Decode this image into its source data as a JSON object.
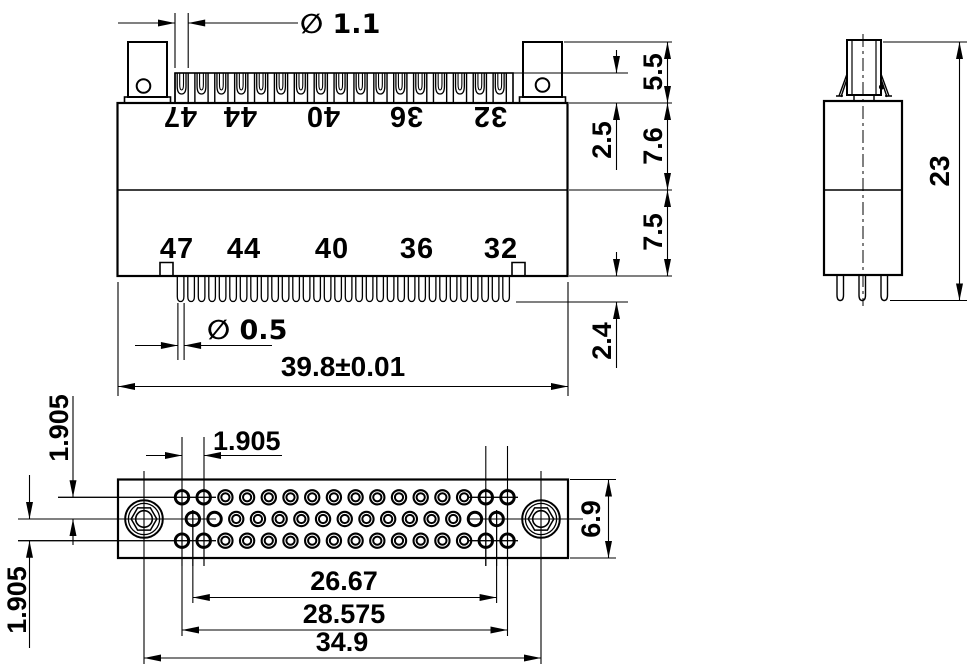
{
  "drawing_type": "connector-technical-drawing",
  "views": {
    "front": {
      "upper_labels": [
        "47",
        "44",
        "40",
        "36",
        "32"
      ],
      "lower_labels": [
        "47",
        "44",
        "40",
        "36",
        "32"
      ],
      "slot_count": 17,
      "pin_count": 32,
      "dims": {
        "slot_width_dia": "∅ 1.1",
        "pin_width_dia": "∅ 0.5",
        "overall_width": "39.8±0.01",
        "tab_height": "5.5",
        "upper_body_height": "7.6",
        "lower_body_height": "7.5",
        "contact_recess": "2.5",
        "pin_protrusion": "2.4"
      }
    },
    "side": {
      "pin_count": 3,
      "dims": {
        "overall_height": "23"
      }
    },
    "face": {
      "outer_row_holes": 16,
      "middle_row_holes": 15,
      "dims": {
        "hole_pitch": "1.905",
        "row_pitch_upper": "1.905",
        "row_pitch_lower": "1.905",
        "middle_row_span": "26.67",
        "outer_row_span": "28.575",
        "mount_hole_span": "34.9",
        "face_height": "6.9"
      }
    }
  },
  "colors": {
    "line": "#000000",
    "background": "#ffffff"
  }
}
